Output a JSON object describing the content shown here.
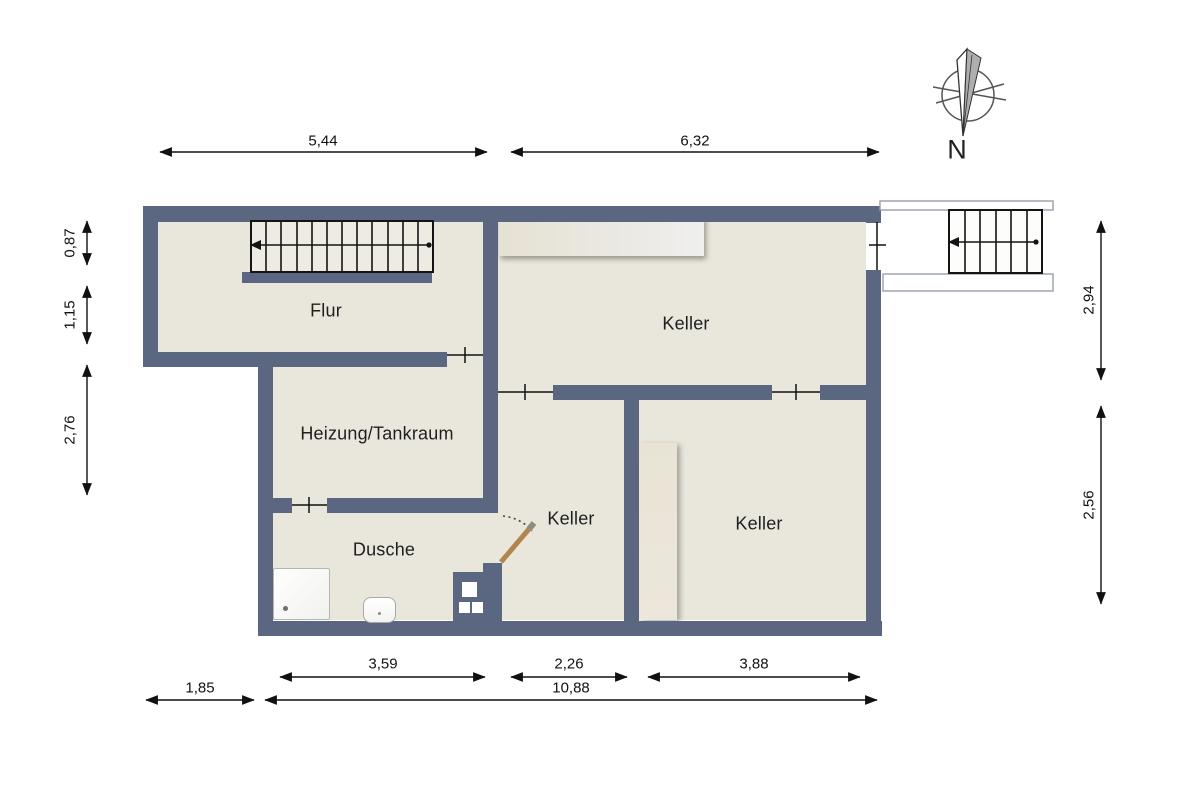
{
  "colors": {
    "wall": "#5b6780",
    "floor": "#e9e6db",
    "door_leaf": "#b2854f"
  },
  "compass": {
    "north_label": "N"
  },
  "rooms": {
    "flur": "Flur",
    "keller_top": "Keller",
    "heizung_tankraum": "Heizung/Tankraum",
    "dusche": "Dusche",
    "keller_mitte": "Keller",
    "keller_rechts": "Keller"
  },
  "dimensions": {
    "top_left_width": "5,44",
    "top_right_width": "6,32",
    "left_upper": "0,87",
    "left_middle": "1,15",
    "left_lower": "2,76",
    "right_upper": "2,94",
    "right_lower": "2,56",
    "bottom_dusche_width": "3,59",
    "bottom_keller_mitte_width": "2,26",
    "bottom_keller_rechts_width": "3,88",
    "bottom_offset_left": "1,85",
    "bottom_total_width": "10,88"
  }
}
